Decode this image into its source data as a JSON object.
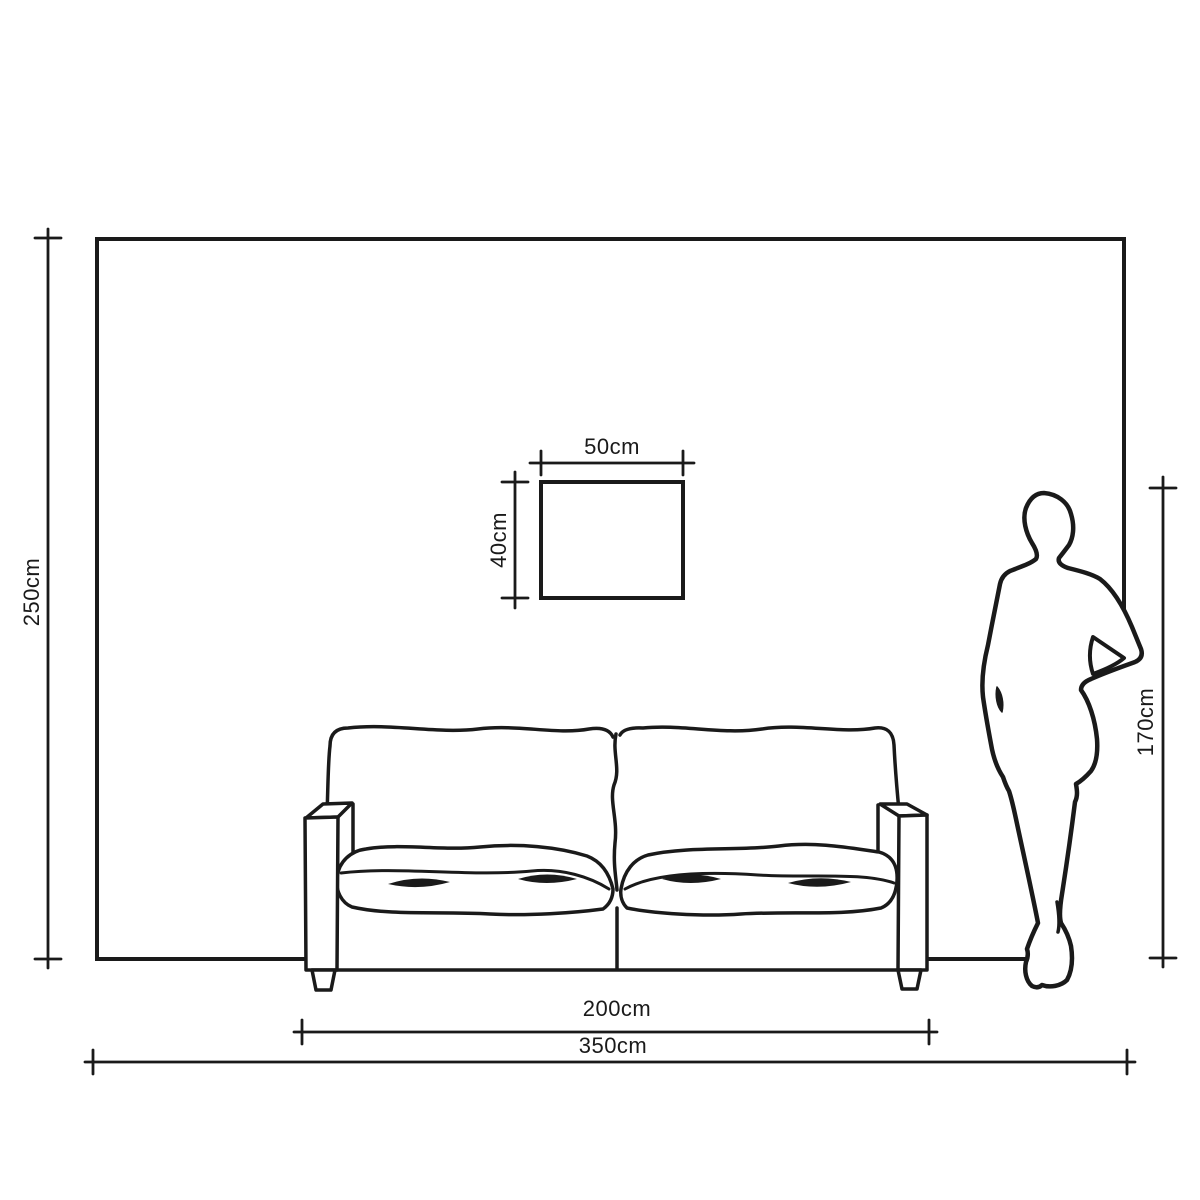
{
  "meta": {
    "drawing_type": "dimensioned wall elevation diagram",
    "units": "cm"
  },
  "colors": {
    "background": "#ffffff",
    "ink": "#1a1a1a"
  },
  "labels": {
    "wall_height": "250cm",
    "wall_width": "350cm",
    "sofa_width": "200cm",
    "person_height": "170cm",
    "frame_width": "50cm",
    "frame_height": "40cm"
  },
  "objects": {
    "wall": "wall outline",
    "frame": "picture frame",
    "sofa": "two-seat sofa",
    "person": "standing figure"
  }
}
